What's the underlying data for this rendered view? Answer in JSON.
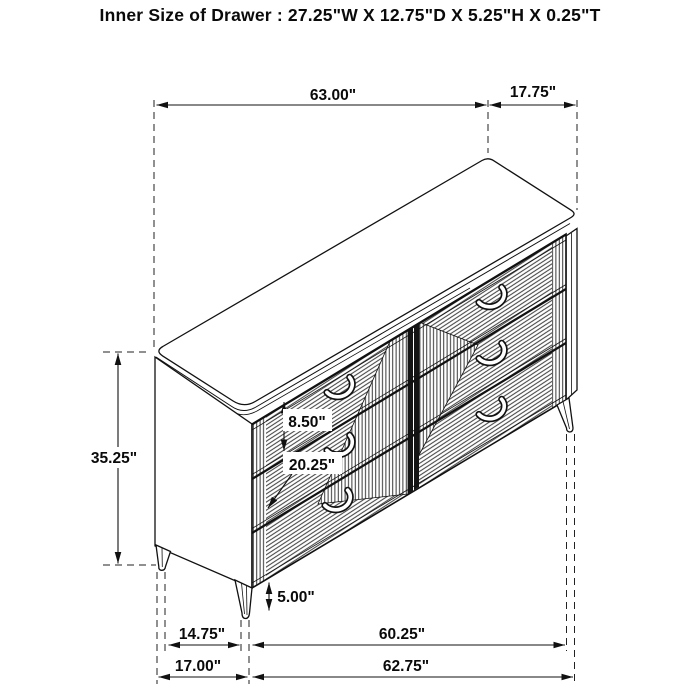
{
  "title": "Inner Size of Drawer : 27.25\"W X 12.75\"D X 5.25\"H X 0.25\"T",
  "dimensions": {
    "top_width": "63.00\"",
    "top_depth": "17.75\"",
    "overall_height": "35.25\"",
    "drawer_front_height": "8.50\"",
    "drawer_opening_width": "20.25\"",
    "leg_height": "5.00\"",
    "base_depth_inner": "14.75\"",
    "base_width_inner": "60.25\"",
    "base_depth": "17.00\"",
    "base_width": "62.75\""
  },
  "figure": {
    "subject": "six-drawer dresser isometric line drawing",
    "drawer_count": 6,
    "visible_legs": 3
  },
  "colors": {
    "line": "#111111",
    "background": "#ffffff"
  }
}
